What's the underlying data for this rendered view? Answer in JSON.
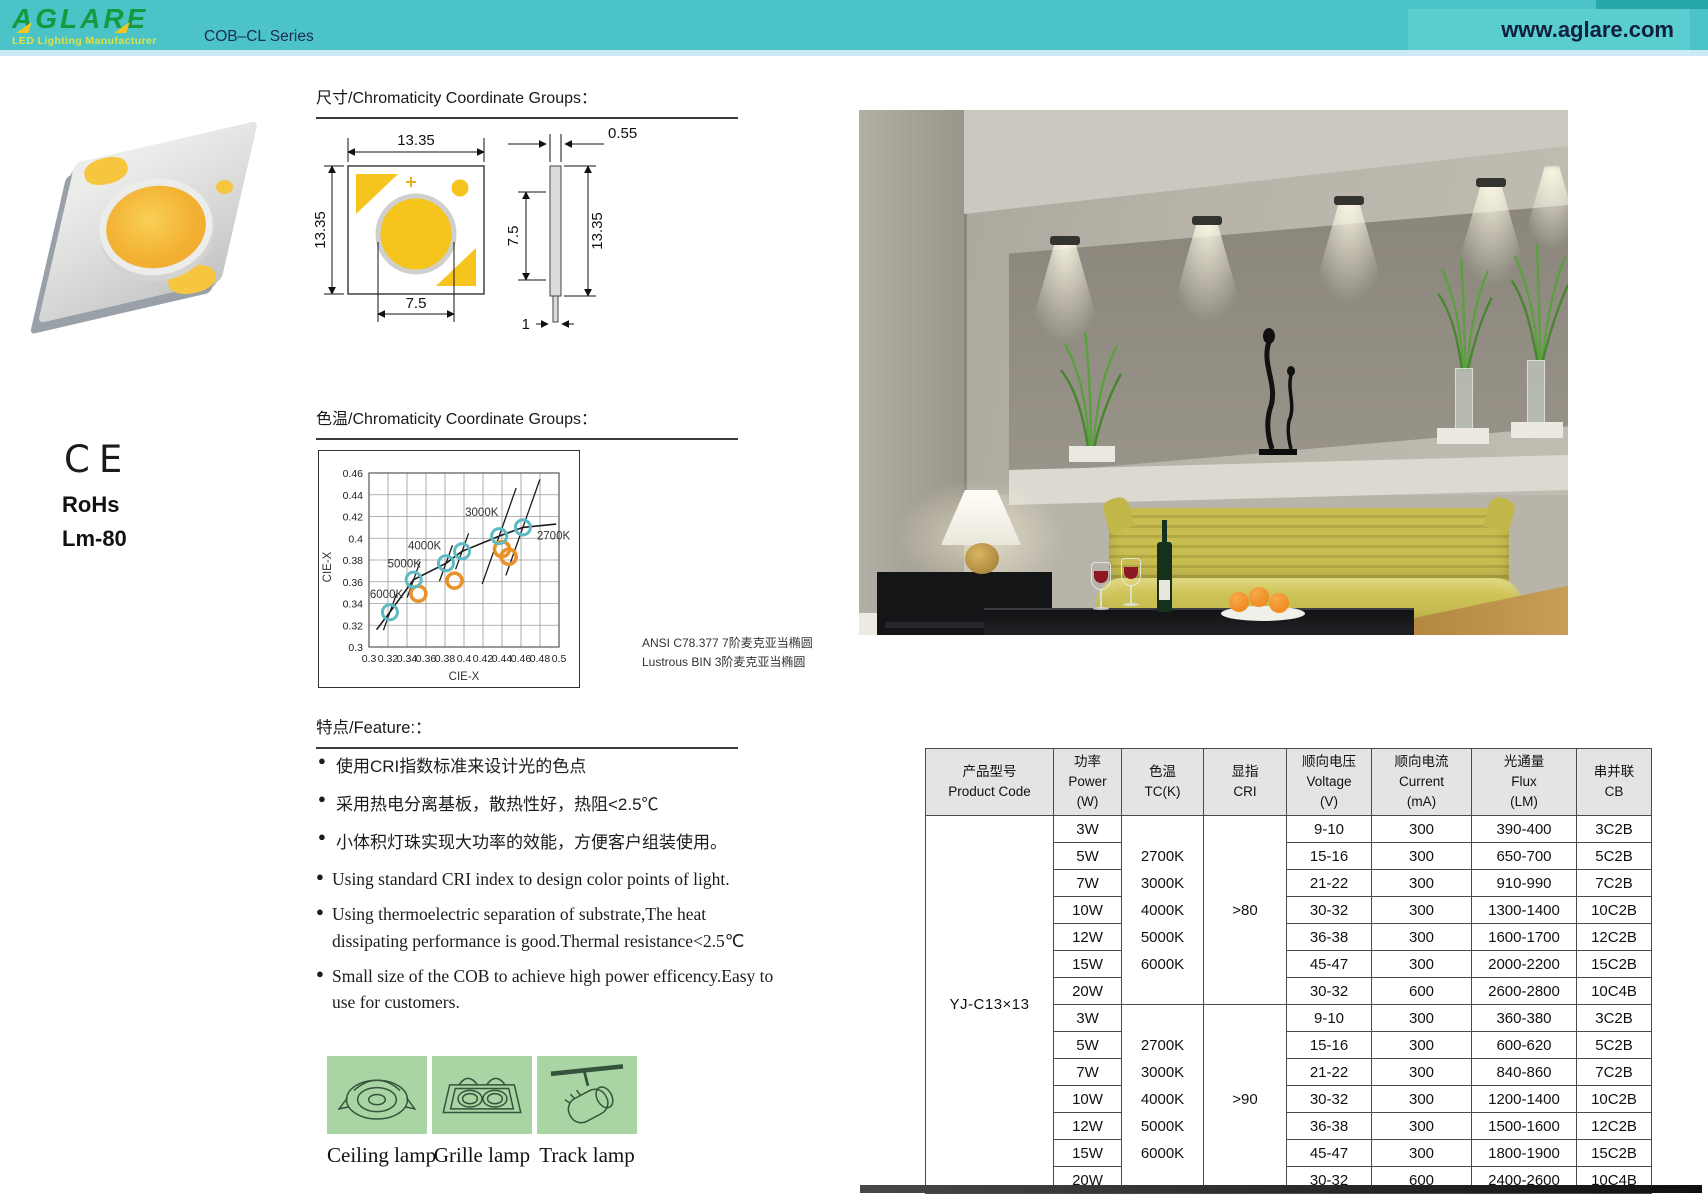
{
  "header": {
    "brand": "AGLARE",
    "tagline": "LED Lighting Manufacturer",
    "series": "COB–CL Series",
    "website": "www.aglare.com"
  },
  "certs": {
    "ce": "CE",
    "rohs": "RoHs",
    "lm": "Lm-80"
  },
  "sections": {
    "dimensions_title": "尺寸/Chromaticity Coordinate Groups：",
    "chart_title": "色温/Chromaticity Coordinate Groups：",
    "features_title": "特点/Feature:："
  },
  "dimensions": {
    "front": {
      "width": "13.35",
      "height": "13.35",
      "circle": "7.5"
    },
    "side": {
      "thickness": "0.55",
      "inner": "7.5",
      "height": "13.35",
      "bottom": "1"
    }
  },
  "chart_data": {
    "type": "scatter",
    "title": "色温/Chromaticity Coordinate Groups",
    "xlabel": "CIE-X",
    "ylabel": "CIE-X",
    "xlim": [
      0.3,
      0.5
    ],
    "ylim": [
      0.3,
      0.46
    ],
    "x_ticks": [
      "0.3",
      "0.32",
      "0.34",
      "0.36",
      "0.38",
      "0.4",
      "0.42",
      "0.44",
      "0.46",
      "0.48",
      "0.5"
    ],
    "y_ticks": [
      "0.3",
      "0.32",
      "0.34",
      "0.36",
      "0.38",
      "0.4",
      "0.42",
      "0.44",
      "0.46"
    ],
    "grid": true,
    "locus_curve": [
      [
        0.308,
        0.316
      ],
      [
        0.322,
        0.332
      ],
      [
        0.347,
        0.362
      ],
      [
        0.381,
        0.377
      ],
      [
        0.398,
        0.388
      ],
      [
        0.437,
        0.402
      ],
      [
        0.462,
        0.41
      ],
      [
        0.497,
        0.413
      ]
    ],
    "series": [
      {
        "name": "ANSI CCT bins",
        "color": "#5bbac4",
        "points": [
          {
            "label": "6000K",
            "x": 0.322,
            "y": 0.332
          },
          {
            "label": "5000K",
            "x": 0.347,
            "y": 0.362
          },
          {
            "label": "4000K",
            "x": 0.381,
            "y": 0.377
          },
          {
            "label": "",
            "x": 0.398,
            "y": 0.388
          },
          {
            "label": "3000K",
            "x": 0.437,
            "y": 0.402
          },
          {
            "label": "2700K",
            "x": 0.462,
            "y": 0.41
          }
        ]
      },
      {
        "name": "Lustrous BIN",
        "color": "#e8922c",
        "points": [
          {
            "label": "",
            "x": 0.352,
            "y": 0.349
          },
          {
            "label": "",
            "x": 0.39,
            "y": 0.361
          },
          {
            "label": "",
            "x": 0.44,
            "y": 0.39
          },
          {
            "label": "",
            "x": 0.447,
            "y": 0.383
          }
        ]
      }
    ],
    "notes": [
      "ANSI C78.377 7阶麦克亚当椭圆",
      "Lustrous BIN 3阶麦克亚当椭圆"
    ]
  },
  "features": {
    "cn": [
      "使用CRI指数标准来设计光的色点",
      "采用热电分离基板，散热性好，热阻<2.5℃",
      "小体积灯珠实现大功率的效能，方便客户组装使用。"
    ],
    "en": [
      "Using standard CRI index to design color points of light.",
      "Using thermoelectric separation of substrate,The heat dissipating performance is good.Thermal resistance<2.5℃",
      "Small size of the COB to achieve high power efficency.Easy to use for customers."
    ]
  },
  "applications": [
    {
      "label": "Ceiling lamp",
      "icon": "ceiling-lamp-icon"
    },
    {
      "label": "Grille lamp",
      "icon": "grille-lamp-icon"
    },
    {
      "label": "Track lamp",
      "icon": "track-lamp-icon"
    }
  ],
  "table": {
    "headers": [
      {
        "cn": "产品型号",
        "en": "Product Code",
        "unit": ""
      },
      {
        "cn": "功率",
        "en": "Power",
        "unit": "(W)"
      },
      {
        "cn": "色温",
        "en": "TC(K)",
        "unit": ""
      },
      {
        "cn": "显指",
        "en": "CRI",
        "unit": ""
      },
      {
        "cn": "顺向电压",
        "en": "Voltage",
        "unit": "(V)"
      },
      {
        "cn": "顺向电流",
        "en": "Current",
        "unit": "(mA)"
      },
      {
        "cn": "光通量",
        "en": "Flux",
        "unit": "(LM)"
      },
      {
        "cn": "串并联",
        "en": "CB",
        "unit": ""
      }
    ],
    "product_code": "YJ-C13×13",
    "groups": [
      {
        "cri": ">80",
        "tc": [
          "2700K",
          "3000K",
          "4000K",
          "5000K",
          "6000K"
        ],
        "rows": [
          {
            "power": "3W",
            "voltage": "9-10",
            "current": "300",
            "flux": "390-400",
            "cb": "3C2B"
          },
          {
            "power": "5W",
            "voltage": "15-16",
            "current": "300",
            "flux": "650-700",
            "cb": "5C2B"
          },
          {
            "power": "7W",
            "voltage": "21-22",
            "current": "300",
            "flux": "910-990",
            "cb": "7C2B"
          },
          {
            "power": "10W",
            "voltage": "30-32",
            "current": "300",
            "flux": "1300-1400",
            "cb": "10C2B"
          },
          {
            "power": "12W",
            "voltage": "36-38",
            "current": "300",
            "flux": "1600-1700",
            "cb": "12C2B"
          },
          {
            "power": "15W",
            "voltage": "45-47",
            "current": "300",
            "flux": "2000-2200",
            "cb": "15C2B"
          },
          {
            "power": "20W",
            "voltage": "30-32",
            "current": "600",
            "flux": "2600-2800",
            "cb": "10C4B"
          }
        ]
      },
      {
        "cri": ">90",
        "tc": [
          "2700K",
          "3000K",
          "4000K",
          "5000K",
          "6000K"
        ],
        "rows": [
          {
            "power": "3W",
            "voltage": "9-10",
            "current": "300",
            "flux": "360-380",
            "cb": "3C2B"
          },
          {
            "power": "5W",
            "voltage": "15-16",
            "current": "300",
            "flux": "600-620",
            "cb": "5C2B"
          },
          {
            "power": "7W",
            "voltage": "21-22",
            "current": "300",
            "flux": "840-860",
            "cb": "7C2B"
          },
          {
            "power": "10W",
            "voltage": "30-32",
            "current": "300",
            "flux": "1200-1400",
            "cb": "10C2B"
          },
          {
            "power": "12W",
            "voltage": "36-38",
            "current": "300",
            "flux": "1500-1600",
            "cb": "12C2B"
          },
          {
            "power": "15W",
            "voltage": "45-47",
            "current": "300",
            "flux": "1800-1900",
            "cb": "15C2B"
          },
          {
            "power": "20W",
            "voltage": "30-32",
            "current": "600",
            "flux": "2400-2600",
            "cb": "10C4B"
          }
        ]
      }
    ]
  }
}
